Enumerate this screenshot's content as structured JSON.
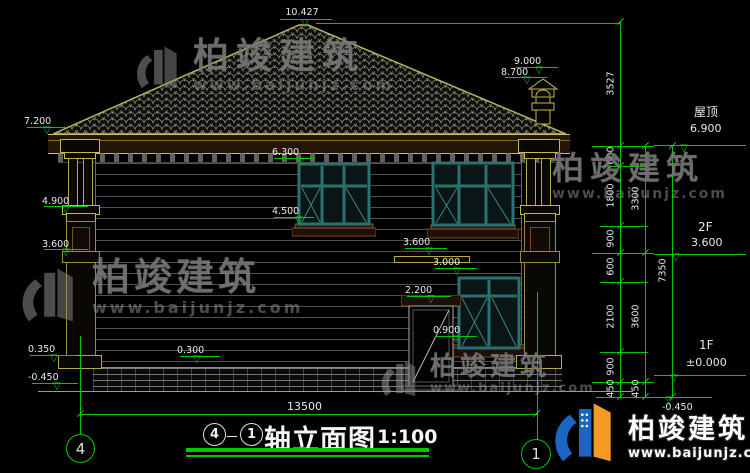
{
  "brand": {
    "name": "柏竣建筑",
    "url": "www.baijunjz.com"
  },
  "title": {
    "axis_from": "4",
    "dash": "－",
    "axis_to": "1",
    "text": "轴立面图",
    "scale": "1:100"
  },
  "axes": {
    "left": "4",
    "right": "1"
  },
  "overall_dim": "13500",
  "levels": {
    "apex": "10.427",
    "chimney_top": "9.000",
    "chimney_cap": "8.700",
    "eave": "7.200",
    "win2_top": "6.300",
    "capital": "4.900",
    "win2_sill": "4.500",
    "band_left": "3.600",
    "band_mid": "3.600",
    "win1_top": "3.000",
    "door_top": "2.200",
    "win1_sill": "0.900",
    "plinth": "0.350",
    "base_mid": "0.300",
    "ground_left": "-0.450",
    "roof_label": "屋顶",
    "roof": "6.900",
    "f2_label": "2F",
    "f2": "3.600",
    "f1_label": "1F",
    "f1": "±0.000",
    "ground_right": "-0.450"
  },
  "chains": {
    "a": [
      "3527",
      "600",
      "1800",
      "900",
      "600",
      "2100",
      "900",
      "450"
    ],
    "b": [
      "3300",
      "3600",
      "450"
    ],
    "c": [
      "7350"
    ]
  },
  "colors": {
    "dim_green": "#00c800",
    "cad_yellow": "#c8b84a",
    "window_teal": "#2d7070",
    "trim_brown": "#7a4a26",
    "logo_blue": "#1a66c2",
    "logo_orange": "#f59a23"
  }
}
